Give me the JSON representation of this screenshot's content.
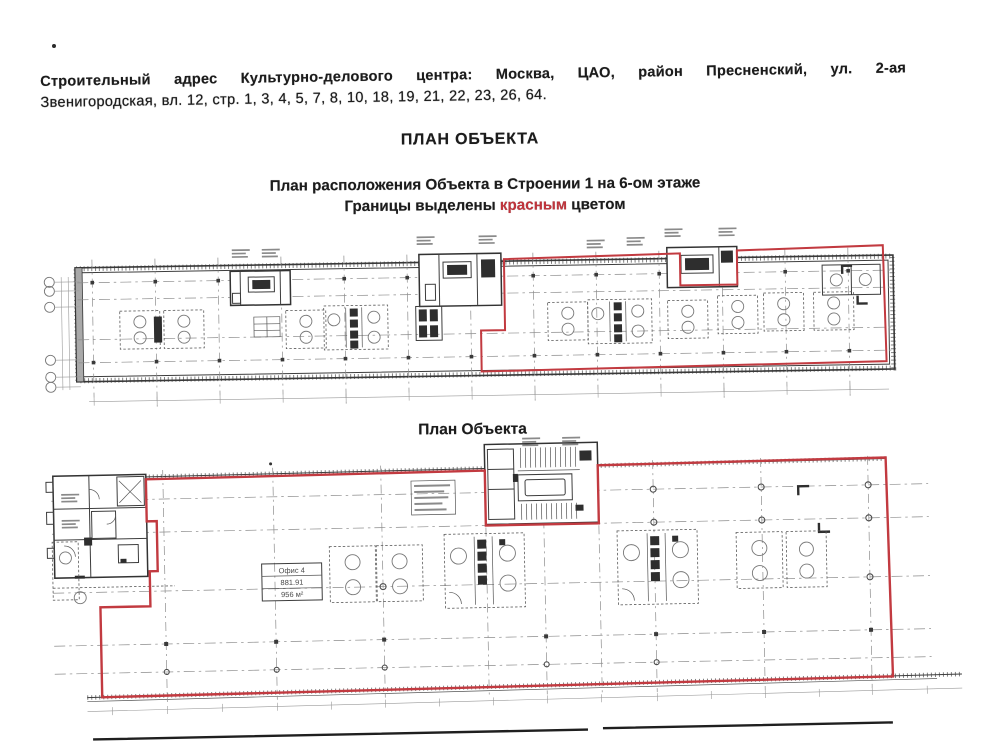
{
  "address": {
    "lead": "Строительный адрес Культурно-делового центра:",
    "line1_rest": "Москва, ЦАО, район Пресненский, ул. 2-ая",
    "line2": "Звенигородская, вл. 12, стр. 1, 3, 4, 5, 7, 8, 10, 18, 19, 21, 22, 23, 26, 64."
  },
  "headings": {
    "main": "ПЛАН ОБЪЕКТА",
    "sub1": "План расположения Объекта в Строении 1 на 6-ом этаже",
    "sub2_prefix": "Границы выделены ",
    "sub2_red": "красным",
    "sub2_suffix": " цветом",
    "plan2": "План Объекта"
  },
  "office_stamp": {
    "line1": "Офис 4",
    "line2": "881.91",
    "line3": "956 м²"
  },
  "colors": {
    "boundary_red": "#c23a40",
    "drawing_ink": "#3d3d3d",
    "grid_gray": "#8c8c8c",
    "paper": "#ffffff"
  }
}
